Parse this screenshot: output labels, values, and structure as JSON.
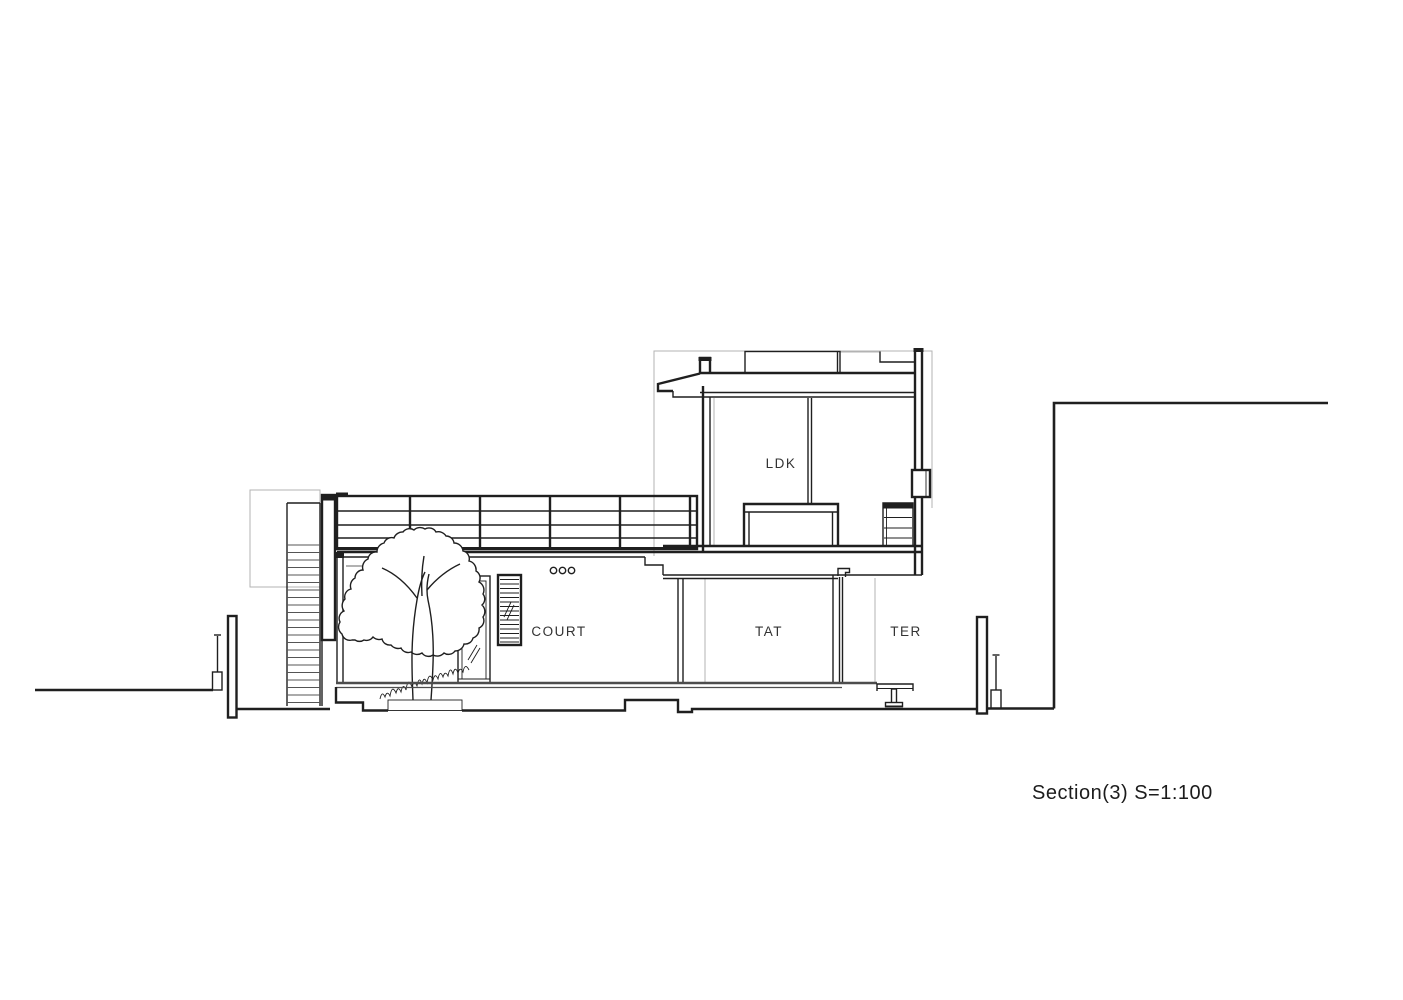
{
  "drawing": {
    "labels": {
      "ldk": "LDK",
      "court": "COURT",
      "tat": "TAT",
      "ter": "TER"
    },
    "caption": "Section(3)  S=1:100",
    "colors": {
      "line": "#1f1f1f",
      "light_outline": "#b3b3b3",
      "ground": "#4d4d4d",
      "background": "#ffffff"
    }
  }
}
